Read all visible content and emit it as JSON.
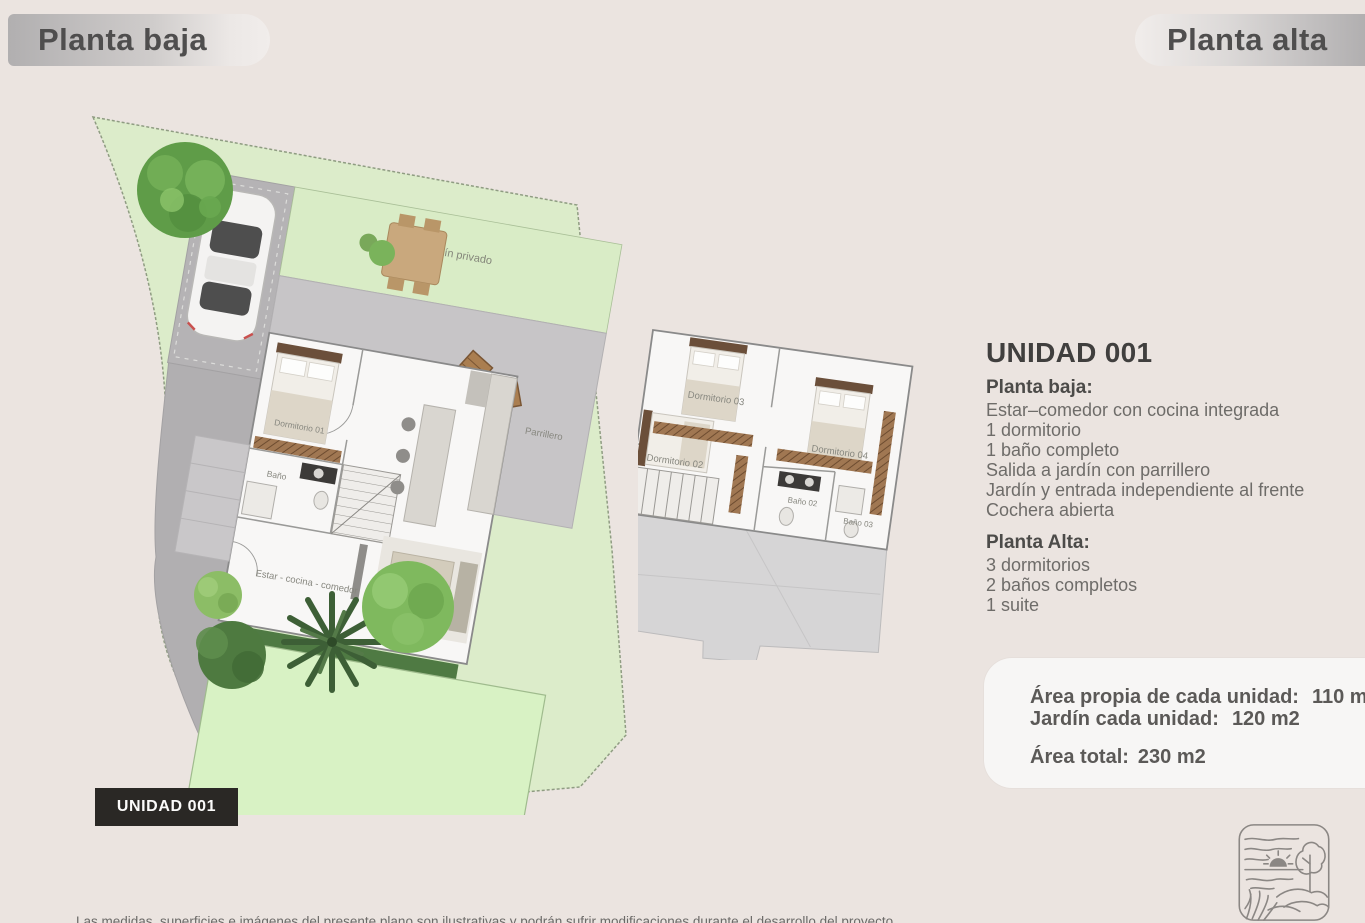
{
  "header": {
    "planta_baja": "Planta baja",
    "planta_alta": "Planta alta"
  },
  "ground_plan": {
    "jardin_privado": "Jardín privado",
    "parrillero": "Parrillero",
    "dormitorio_01": "Dormitorio 01",
    "bano": "Baño",
    "estar": "Estar - cocina - comedor"
  },
  "upper_plan": {
    "dormitorio_03": "Dormitorio 03",
    "dormitorio_02": "Dormitorio 02",
    "dormitorio_04": "Dormitorio 04",
    "bano_02": "Baño 02",
    "bano_03": "Baño 03"
  },
  "unit_info": {
    "title": "UNIDAD 001",
    "planta_baja_heading": "Planta baja:",
    "planta_baja_items": [
      "Estar–comedor con cocina integrada",
      "1 dormitorio",
      "1 baño completo",
      "Salida a jardín con parrillero",
      "Jardín y entrada independiente al frente",
      "Cochera abierta"
    ],
    "planta_alta_heading": "Planta Alta:",
    "planta_alta_items": [
      "3 dormitorios",
      "2 baños completos",
      "1 suite"
    ]
  },
  "area_box": {
    "line1_label": "Área propia de cada unidad:",
    "line1_value": "110 m2",
    "line2_label": "Jardín cada unidad:",
    "line2_value": "120 m2",
    "total_label": "Área total:",
    "total_value": "230 m2"
  },
  "unit_badge": "UNIDAD 001",
  "footer": {
    "disclaimer": "Las medidas, superficies e imágenes del presente plano son ilustrativas y podrán sufrir modificaciones durante el desarrollo del proyecto"
  },
  "colors": {
    "background": "#ebe4e0",
    "garden_pale": "#dcecca",
    "garden_bright": "#d8f2c4",
    "road_gray": "#b1afb1",
    "terrace_gray": "#c7c5c7",
    "roof_gray": "#d6d5d6",
    "badge_black": "#2a2825",
    "area_box_white": "#f7f6f5"
  },
  "icons": {
    "logo": "landscape-logo"
  }
}
